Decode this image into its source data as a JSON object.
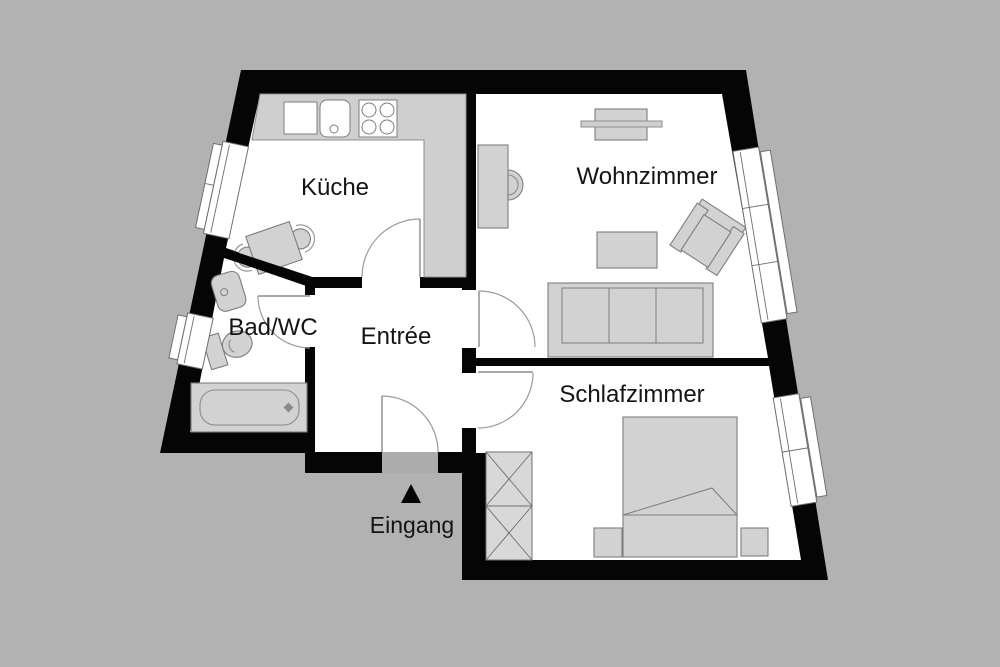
{
  "plan": {
    "type": "apartment-floor-plan",
    "rooms": [
      {
        "id": "kueche",
        "label": "Küche"
      },
      {
        "id": "wohnzimmer",
        "label": "Wohnzimmer"
      },
      {
        "id": "bad",
        "label": "Bad/WC"
      },
      {
        "id": "entree",
        "label": "Entrée"
      },
      {
        "id": "schlafzimmer",
        "label": "Schlafzimmer"
      }
    ],
    "entrance": {
      "label": "Eingang",
      "marker": "up-triangle"
    },
    "fixtures": [
      "sink-icon",
      "stove-icon",
      "kitchen-table-icon",
      "chair-icon",
      "washbasin-icon",
      "toilet-icon",
      "bathtub-icon",
      "tv-lowboard-icon",
      "desk-icon",
      "desk-chair-icon",
      "coffee-table-icon",
      "armchair-icon",
      "sofa-icon",
      "wardrobe-icon",
      "double-bed-icon",
      "nightstand-icon",
      "window-icon",
      "door-swing-icon",
      "entrance-arrow-icon"
    ],
    "colors": {
      "background": "#b2b2b2",
      "wall": "#050505",
      "floor": "#ffffff",
      "furniture_fill": "#d2d2d2",
      "furniture_stroke": "#7d7d7d",
      "counter_fill": "#cfcfcf",
      "door_arc": "#9a9a9a",
      "threshold": "#acacac",
      "label_text": "#141414"
    }
  }
}
